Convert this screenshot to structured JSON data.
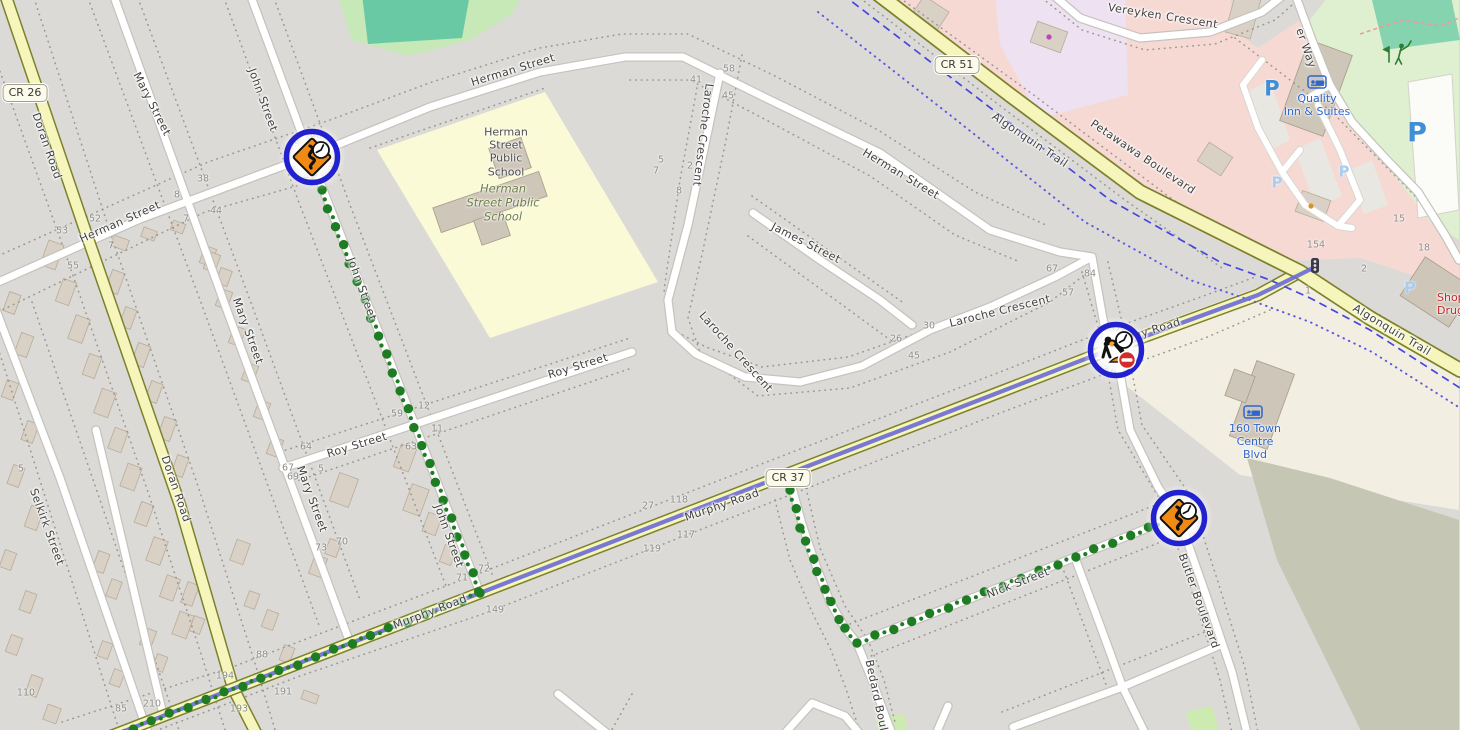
{
  "theme": {
    "colors": {
      "land_grey": "#dbdad7",
      "land_beige": "#f2eee1",
      "land_pink": "#f7d9d4",
      "land_purple": "#eee1f1",
      "land_school_yellow": "#fbfad6",
      "land_park_green": "#c7e8b7",
      "land_pitch_teal": "#68c9a4",
      "land_golf_green": "#def0d0",
      "land_olive": "#c6c6b4",
      "road_yellow": "#f6f6bc",
      "route_green": "#1e7d23",
      "route_blue": "#6b6bd6",
      "trail_blue": "#4646df",
      "marker_ring_blue": "#2121cf",
      "marker_sign_orange": "#f08a15",
      "no_entry_red": "#d52b2b",
      "street_label": "#3f3f3d",
      "house_number": "#8e8d88",
      "shield_bg": "#fcfaea",
      "poi_blue": "#2f66cc",
      "poi_red": "#c62828",
      "poi_dark": "#4d4d4b",
      "poi_green": "#6f7d42",
      "p_bold": "#3f8ed8",
      "p_light": "#a9cdef"
    }
  },
  "shields": [
    {
      "label": "CR 26",
      "x": 25,
      "y": 93
    },
    {
      "label": "CR 51",
      "x": 957,
      "y": 65
    },
    {
      "label": "CR 37",
      "x": 788,
      "y": 478
    }
  ],
  "street_labels": [
    {
      "text": "Mary Street",
      "x": 152,
      "y": 104,
      "rotate": 63
    },
    {
      "text": "John Street",
      "x": 263,
      "y": 100,
      "rotate": 70
    },
    {
      "text": "Herman Street",
      "x": 120,
      "y": 222,
      "rotate": -24
    },
    {
      "text": "Doran Road",
      "x": 47,
      "y": 146,
      "rotate": 71
    },
    {
      "text": "Herman Street",
      "x": 513,
      "y": 70,
      "rotate": -17
    },
    {
      "text": "Herman Street",
      "x": 901,
      "y": 174,
      "rotate": 31
    },
    {
      "text": "Laroche Crescent",
      "x": 703,
      "y": 135,
      "rotate": 97
    },
    {
      "text": "James Street",
      "x": 806,
      "y": 243,
      "rotate": 27
    },
    {
      "text": "Laroche Crescent",
      "x": 736,
      "y": 352,
      "rotate": 48
    },
    {
      "text": "Laroche Crescent",
      "x": 1000,
      "y": 311,
      "rotate": -14
    },
    {
      "text": "Roy Street",
      "x": 357,
      "y": 445,
      "rotate": -17
    },
    {
      "text": "Roy Street",
      "x": 578,
      "y": 366,
      "rotate": -17
    },
    {
      "text": "John Street",
      "x": 362,
      "y": 289,
      "rotate": 70
    },
    {
      "text": "John Street",
      "x": 449,
      "y": 536,
      "rotate": 70
    },
    {
      "text": "Mary Street",
      "x": 248,
      "y": 331,
      "rotate": 70
    },
    {
      "text": "Mary Street",
      "x": 312,
      "y": 499,
      "rotate": 70
    },
    {
      "text": "Selkirk Street",
      "x": 47,
      "y": 527,
      "rotate": 70
    },
    {
      "text": "Doran Road",
      "x": 176,
      "y": 489,
      "rotate": 71
    },
    {
      "text": "Murphy Road",
      "x": 430,
      "y": 612,
      "rotate": -21
    },
    {
      "text": "Murphy Road",
      "x": 722,
      "y": 505,
      "rotate": -19
    },
    {
      "text": "Murphy Road",
      "x": 1143,
      "y": 333,
      "rotate": -17
    },
    {
      "text": "Nick Street",
      "x": 1018,
      "y": 583,
      "rotate": -21
    },
    {
      "text": "Bedard Boulevard",
      "x": 880,
      "y": 712,
      "rotate": 78
    },
    {
      "text": "Butler Boulevard",
      "x": 1199,
      "y": 601,
      "rotate": 70
    },
    {
      "text": "Algonquin Trail",
      "x": 1030,
      "y": 140,
      "rotate": 34
    },
    {
      "text": "Algonquin Trail",
      "x": 1392,
      "y": 330,
      "rotate": 31
    },
    {
      "text": "Petawawa Boulevard",
      "x": 1143,
      "y": 157,
      "rotate": 34
    },
    {
      "text": "Vereyken Crescent",
      "x": 1163,
      "y": 16,
      "rotate": 9
    },
    {
      "text": "er Way",
      "x": 1306,
      "y": 48,
      "rotate": 71
    }
  ],
  "house_numbers": [
    {
      "text": "52",
      "x": 95,
      "y": 219
    },
    {
      "text": "53",
      "x": 62,
      "y": 231
    },
    {
      "text": "55",
      "x": 73,
      "y": 266
    },
    {
      "text": "38",
      "x": 203,
      "y": 179
    },
    {
      "text": "8",
      "x": 177,
      "y": 195
    },
    {
      "text": "44",
      "x": 216,
      "y": 211
    },
    {
      "text": "39",
      "x": 294,
      "y": 144
    },
    {
      "text": "40",
      "x": 316,
      "y": 136
    },
    {
      "text": "41",
      "x": 309,
      "y": 177
    },
    {
      "text": "44",
      "x": 328,
      "y": 166
    },
    {
      "text": "7",
      "x": 186,
      "y": 219
    },
    {
      "text": "7",
      "x": 111,
      "y": 246
    },
    {
      "text": "59",
      "x": 397,
      "y": 414
    },
    {
      "text": "12",
      "x": 424,
      "y": 406
    },
    {
      "text": "11",
      "x": 437,
      "y": 429
    },
    {
      "text": "63",
      "x": 411,
      "y": 447
    },
    {
      "text": "64",
      "x": 306,
      "y": 447
    },
    {
      "text": "5",
      "x": 321,
      "y": 469
    },
    {
      "text": "5",
      "x": 21,
      "y": 469
    },
    {
      "text": "67",
      "x": 288,
      "y": 468
    },
    {
      "text": "69",
      "x": 293,
      "y": 477
    },
    {
      "text": "27",
      "x": 648,
      "y": 506
    },
    {
      "text": "118",
      "x": 679,
      "y": 500
    },
    {
      "text": "117",
      "x": 686,
      "y": 535
    },
    {
      "text": "119",
      "x": 652,
      "y": 549
    },
    {
      "text": "72",
      "x": 484,
      "y": 569
    },
    {
      "text": "71",
      "x": 462,
      "y": 578
    },
    {
      "text": "149",
      "x": 495,
      "y": 610
    },
    {
      "text": "110",
      "x": 26,
      "y": 693
    },
    {
      "text": "85",
      "x": 121,
      "y": 709
    },
    {
      "text": "210",
      "x": 152,
      "y": 704
    },
    {
      "text": "194",
      "x": 225,
      "y": 676
    },
    {
      "text": "193",
      "x": 239,
      "y": 709
    },
    {
      "text": "191",
      "x": 283,
      "y": 692
    },
    {
      "text": "88",
      "x": 262,
      "y": 655
    },
    {
      "text": "73",
      "x": 321,
      "y": 548
    },
    {
      "text": "70",
      "x": 342,
      "y": 542
    },
    {
      "text": "58",
      "x": 729,
      "y": 69
    },
    {
      "text": "41",
      "x": 696,
      "y": 80
    },
    {
      "text": "45",
      "x": 728,
      "y": 96
    },
    {
      "text": "5",
      "x": 661,
      "y": 160
    },
    {
      "text": "7",
      "x": 656,
      "y": 171
    },
    {
      "text": "2",
      "x": 690,
      "y": 166
    },
    {
      "text": "8",
      "x": 679,
      "y": 191
    },
    {
      "text": "67",
      "x": 1052,
      "y": 269
    },
    {
      "text": "57",
      "x": 1068,
      "y": 293
    },
    {
      "text": "84",
      "x": 1090,
      "y": 274
    },
    {
      "text": "30",
      "x": 929,
      "y": 326
    },
    {
      "text": "26",
      "x": 896,
      "y": 339
    },
    {
      "text": "45",
      "x": 914,
      "y": 356
    },
    {
      "text": "37",
      "x": 1109,
      "y": 370
    },
    {
      "text": "36",
      "x": 1120,
      "y": 328
    },
    {
      "text": "154",
      "x": 1316,
      "y": 245
    },
    {
      "text": "15",
      "x": 1399,
      "y": 219
    },
    {
      "text": "18",
      "x": 1424,
      "y": 248
    },
    {
      "text": "2",
      "x": 1364,
      "y": 269
    },
    {
      "text": "1",
      "x": 1308,
      "y": 291
    }
  ],
  "pois": [
    {
      "id": "quality-inn",
      "lines": [
        "Quality",
        "Inn & Suites"
      ],
      "x": 1317,
      "y": 105,
      "color_key": "poi_blue"
    },
    {
      "id": "town-centre",
      "lines": [
        "160 Town",
        "Centre",
        "Blvd"
      ],
      "x": 1255,
      "y": 442,
      "color_key": "poi_blue"
    },
    {
      "id": "shoppers",
      "lines": [
        "Shop",
        "Drug"
      ],
      "x": 1437,
      "y": 304,
      "color_key": "poi_red",
      "align": "left"
    },
    {
      "id": "school-building",
      "lines": [
        "Herman",
        "Street",
        "Public",
        "School"
      ],
      "x": 506,
      "y": 152,
      "color_key": "poi_dark"
    },
    {
      "id": "school-area",
      "lines": [
        "Herman",
        "Street Public",
        "School"
      ],
      "x": 503,
      "y": 203,
      "color_key": "poi_green",
      "italic": true
    }
  ],
  "parking_icons": [
    {
      "letter": "P",
      "x": 1272,
      "y": 89,
      "size": 21,
      "tone": "bold"
    },
    {
      "letter": "P",
      "x": 1417,
      "y": 133,
      "size": 27,
      "tone": "bold"
    },
    {
      "letter": "P",
      "x": 1344,
      "y": 172,
      "size": 15,
      "tone": "light"
    },
    {
      "letter": "P",
      "x": 1277,
      "y": 183,
      "size": 15,
      "tone": "light"
    },
    {
      "letter": "P",
      "x": 1410,
      "y": 288,
      "size": 16,
      "tone": "light"
    }
  ],
  "markers": [
    {
      "id": "marker-herman-john",
      "type": "roadworks-clock",
      "x": 312,
      "y": 157
    },
    {
      "id": "marker-murphy-butler",
      "type": "construction-no-entry-clock",
      "x": 1116,
      "y": 350
    },
    {
      "id": "marker-nick-butler",
      "type": "roadworks-clock",
      "x": 1179,
      "y": 518
    }
  ]
}
